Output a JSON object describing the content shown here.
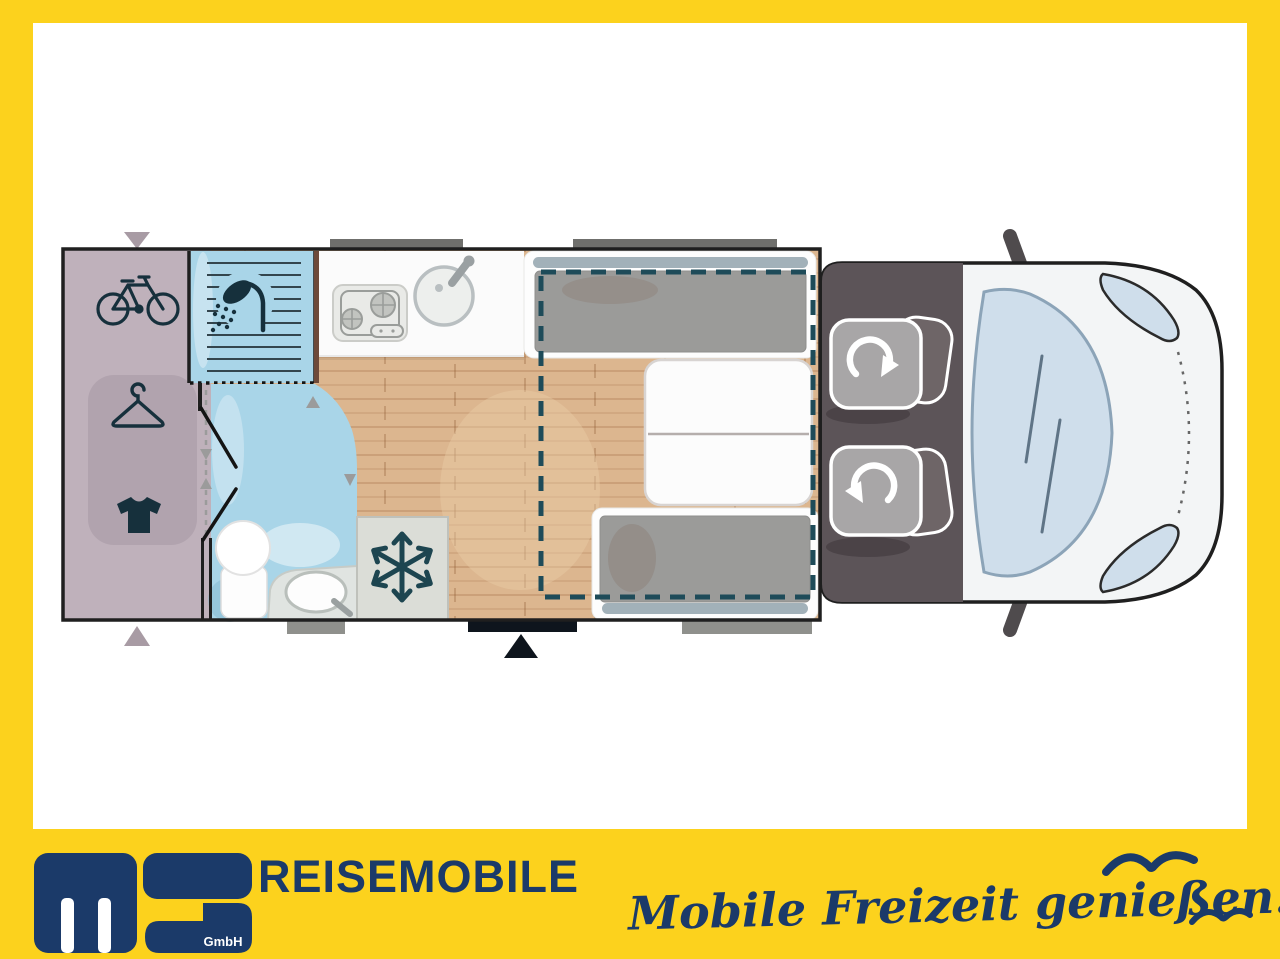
{
  "brand": {
    "logo_text": "ms",
    "company_suffix": "GmbH",
    "wordmark": "REISEMOBILE",
    "slogan": "Mobile Freizeit genießen."
  },
  "colors": {
    "frame_yellow": "#fcd21d",
    "brand_navy": "#1b3a69",
    "plan_outline": "#1f1f1f",
    "garage_mauve": "#bfb1bb",
    "wardrobe_mauve": "#b1a3ae",
    "wetroom_blue": "#a9d5e8",
    "wood_floor": "#dcb68f",
    "kitchen_white": "#fbfbfb",
    "fridge_gray": "#dbddd7",
    "cab_floor": "#5c5458",
    "seat_gray": "#a8a6a7",
    "backrest_gray": "#6e6567",
    "cushion_gray": "#9b9b99",
    "headrest_pill": "#a2b1b9",
    "bed_dash_teal": "#1e4b59",
    "icon_navy": "#16303c",
    "windshield_blue": "#cfdeeb",
    "marker_gray": "#a89ba4",
    "entry_black": "#0e151d"
  },
  "floorplan": {
    "view": "top-down motorhome layout",
    "areas": [
      {
        "id": "rear-garage",
        "icons": [
          "bicycle-icon",
          "clothes-hanger-icon",
          "t-shirt-icon"
        ]
      },
      {
        "id": "shower-cabin",
        "icons": [
          "shower-icon"
        ]
      },
      {
        "id": "washroom",
        "icons": [
          "toilet-icon",
          "washbasin-icon"
        ]
      },
      {
        "id": "kitchen",
        "icons": [
          "hob-icon",
          "kitchen-sink-icon"
        ]
      },
      {
        "id": "fridge",
        "icons": [
          "snowflake-icon"
        ]
      },
      {
        "id": "dinette",
        "icons": [
          "table",
          "facing-bench-seats",
          "drop-down-bed-dashed-outline"
        ]
      },
      {
        "id": "driver-cab",
        "icons": [
          "swivel-seat-icon",
          "swivel-seat-icon",
          "windshield",
          "side-mirrors"
        ]
      }
    ],
    "markers": [
      "garage-door-arrows",
      "entrance-door-arrow"
    ]
  }
}
